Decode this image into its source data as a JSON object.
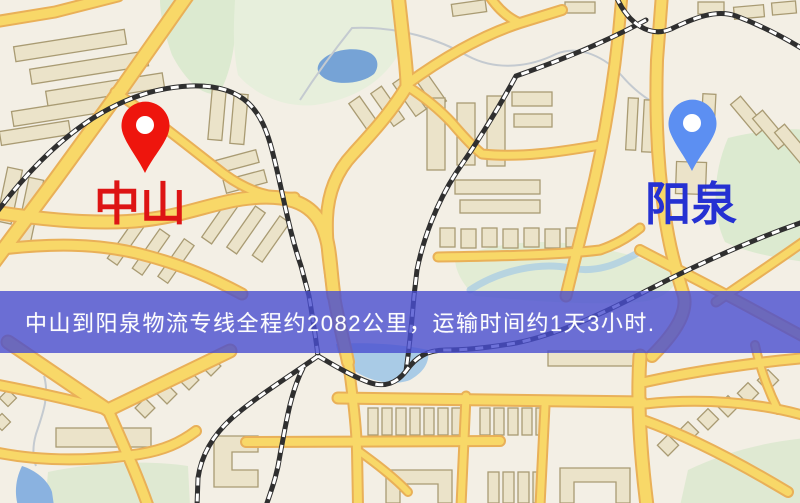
{
  "map": {
    "origin": {
      "name": "中山",
      "label_color": "#dd1414",
      "pin_color": "#ee150d"
    },
    "destination": {
      "name": "阳泉",
      "label_color": "#2531d2",
      "pin_color": "#5c8ff2"
    },
    "banner": {
      "text": "中山到阳泉物流专线全程约2082公里，运输时间约1天3小时.",
      "bg_color": "#484dd0",
      "text_color": "#fdfdfd"
    },
    "route": {
      "distance_km": "2082",
      "duration": "1天3小时"
    },
    "palette": {
      "land": "#f3efe5",
      "road_fill": "#f8d868",
      "road_casing": "#e9b058",
      "building_fill": "#ebe3c9",
      "building_stroke": "#a99b73",
      "park": "#dfead2",
      "water": "#76a3d6",
      "railway": "#2f2f2f"
    }
  }
}
